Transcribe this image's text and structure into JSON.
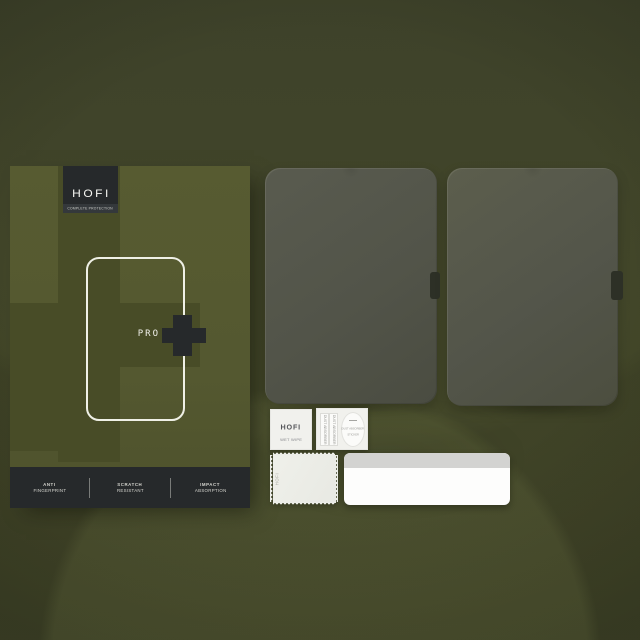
{
  "palette": {
    "background_olive": "#41452a",
    "box_olive": "#545830",
    "box_olive_dark": "#484c27",
    "charcoal": "#26292b",
    "glass_gray": "#53554a",
    "white": "#f4f4f0"
  },
  "box": {
    "brand": "HOFI",
    "tagline": "COMPLETE PROTECTION",
    "product_line": "PRO",
    "features": [
      {
        "line1": "ANTI",
        "line2": "FINGERPRINT"
      },
      {
        "line1": "SCRATCH",
        "line2": "RESISTANT"
      },
      {
        "line1": "IMPACT",
        "line2": "ABSORPTION"
      }
    ]
  },
  "protectors": {
    "count": 2
  },
  "accessories": {
    "wet_wipe": {
      "brand": "HOFI",
      "label": "WET WIPE"
    },
    "dust_stickers": {
      "strip_label": "DUST ABSORBER",
      "sticker_line1": "DUST ABSORBER",
      "sticker_line2": "STICKER"
    },
    "cloth": {
      "brand": "HOFI"
    },
    "squeegee_card": {
      "top_band_color": "#d3d3d1",
      "body_color": "#fdfdfc"
    }
  }
}
